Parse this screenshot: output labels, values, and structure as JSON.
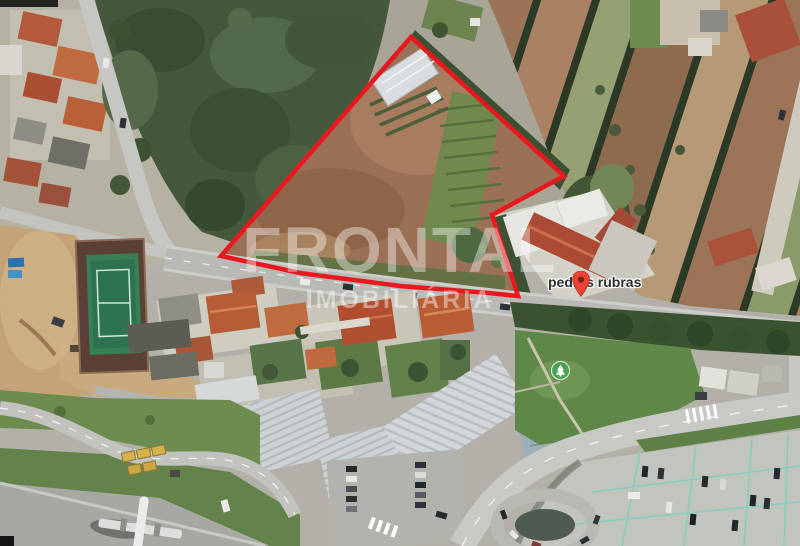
{
  "map": {
    "view": "satellite",
    "place_label": "pedras rubras",
    "watermark": {
      "line1": "FRONTAL",
      "line2": "IMOBILIÁRIA"
    },
    "boundary": {
      "color": "#e7191f",
      "points": "411,37 564,176 492,215 518,296 489,293 400,286 300,273 221,256"
    },
    "icons": {
      "marker": "location-pin-icon",
      "park": "park-tree-icon",
      "airplane": "airplane-icon"
    },
    "colors": {
      "marker_red": "#e94335",
      "marker_dot": "#7e2018",
      "park_green": "#4ca154",
      "watermark_white": "#ffffff"
    }
  }
}
